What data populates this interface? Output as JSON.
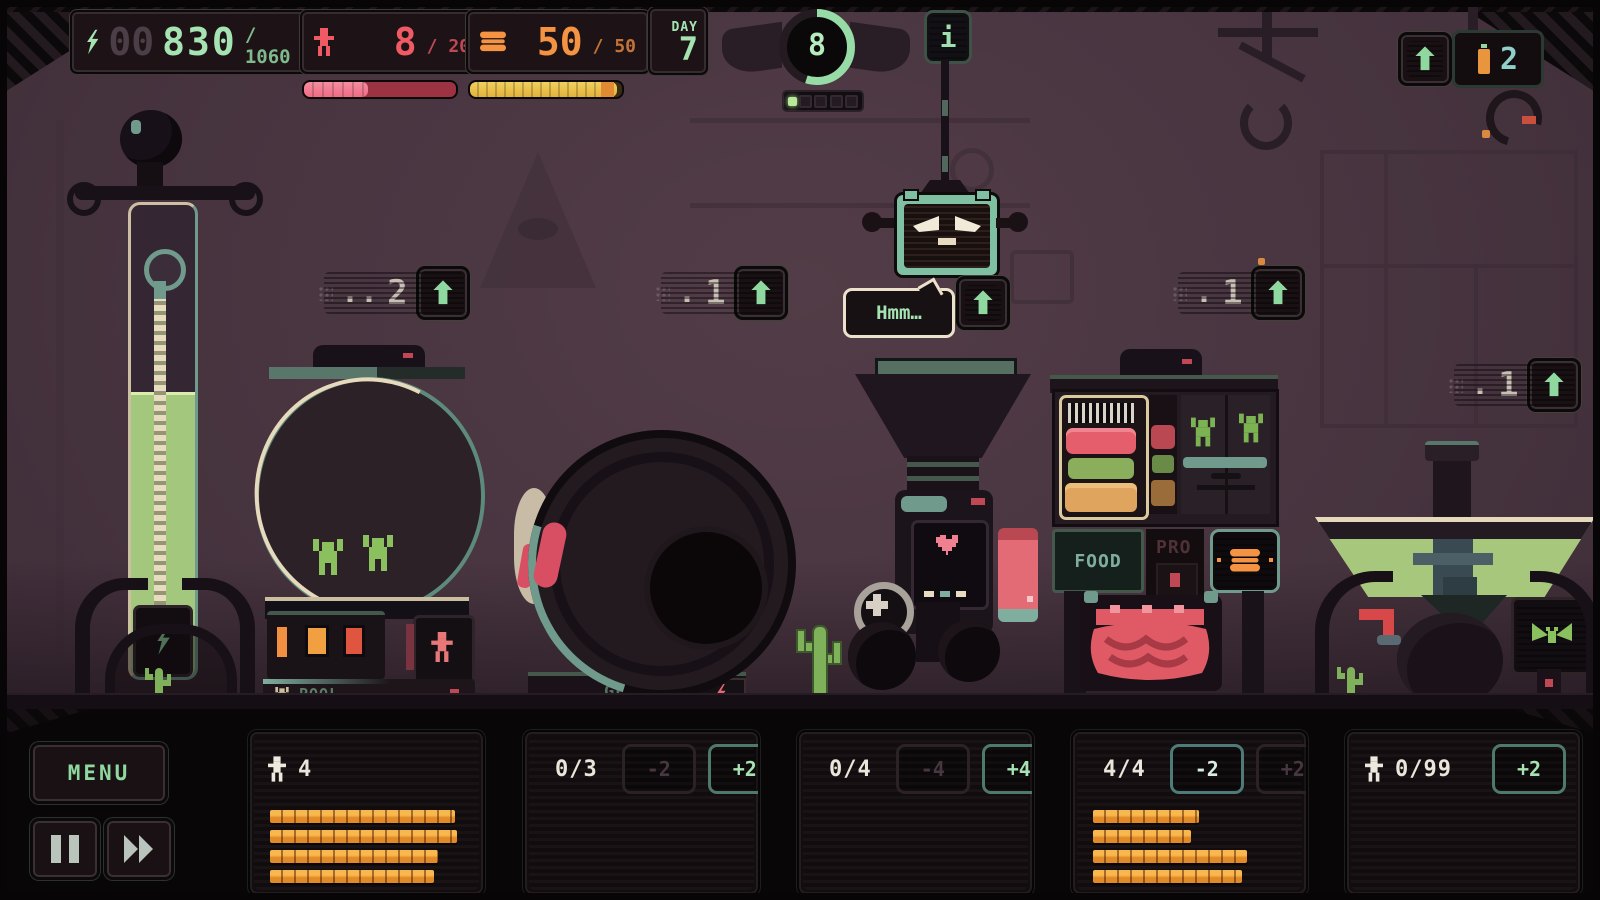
{
  "hud": {
    "energy": {
      "dim_digits": "00",
      "value": "830",
      "max": "/ 1060"
    },
    "population": {
      "value": "8",
      "max": "/ 20",
      "bar_pct": 42
    },
    "food": {
      "value": "50",
      "max": "/ 50",
      "bar_pct": 97
    },
    "day": {
      "label": "DAY",
      "value": "7"
    }
  },
  "wave_counter": {
    "value": "8",
    "arc_pct": 55,
    "pips_total": 5,
    "pips_lit": 1
  },
  "info_sign_label": "i",
  "robot": {
    "speech": "Hmm…"
  },
  "upgrades": {
    "pool": {
      "prefix": "..",
      "cost": "2"
    },
    "gen": {
      "prefix": ".",
      "cost": "1"
    },
    "food": {
      "prefix": ".",
      "cost": "1"
    },
    "right": {
      "prefix": ".",
      "cost": "1"
    }
  },
  "crane_display": {
    "value": "2"
  },
  "labels": {
    "pool": "POOL",
    "gen": "GEN",
    "rep": "REP",
    "food": "FOOD",
    "pro": "PRO"
  },
  "colors": {
    "accent_green": "#8fd8a0",
    "hud_green": "#a5e4b2",
    "red": "#ef5a64",
    "orange": "#f49341",
    "bar_yellow": "#e9c24a",
    "bar_orange": "#e8952f",
    "cost_gray": "#cabfb5"
  },
  "bottom": {
    "menu_label": "MENU",
    "panels": [
      {
        "count": "4",
        "bars": [
          96,
          97,
          87,
          85
        ]
      },
      {
        "count": "0/3",
        "minus_label": "-2",
        "plus_label": "+2",
        "minus_enabled": false,
        "plus_enabled": true,
        "bars": []
      },
      {
        "count": "0/4",
        "minus_label": "-4",
        "plus_label": "+4",
        "minus_enabled": false,
        "plus_enabled": true,
        "bars": []
      },
      {
        "count": "4/4",
        "minus_label": "-2",
        "plus_label": "+2",
        "minus_enabled": true,
        "plus_enabled": false,
        "bars": [
          55,
          51,
          80,
          77
        ]
      },
      {
        "count": "0/99",
        "plus_label": "+2",
        "plus_enabled": true,
        "bars": []
      }
    ]
  }
}
